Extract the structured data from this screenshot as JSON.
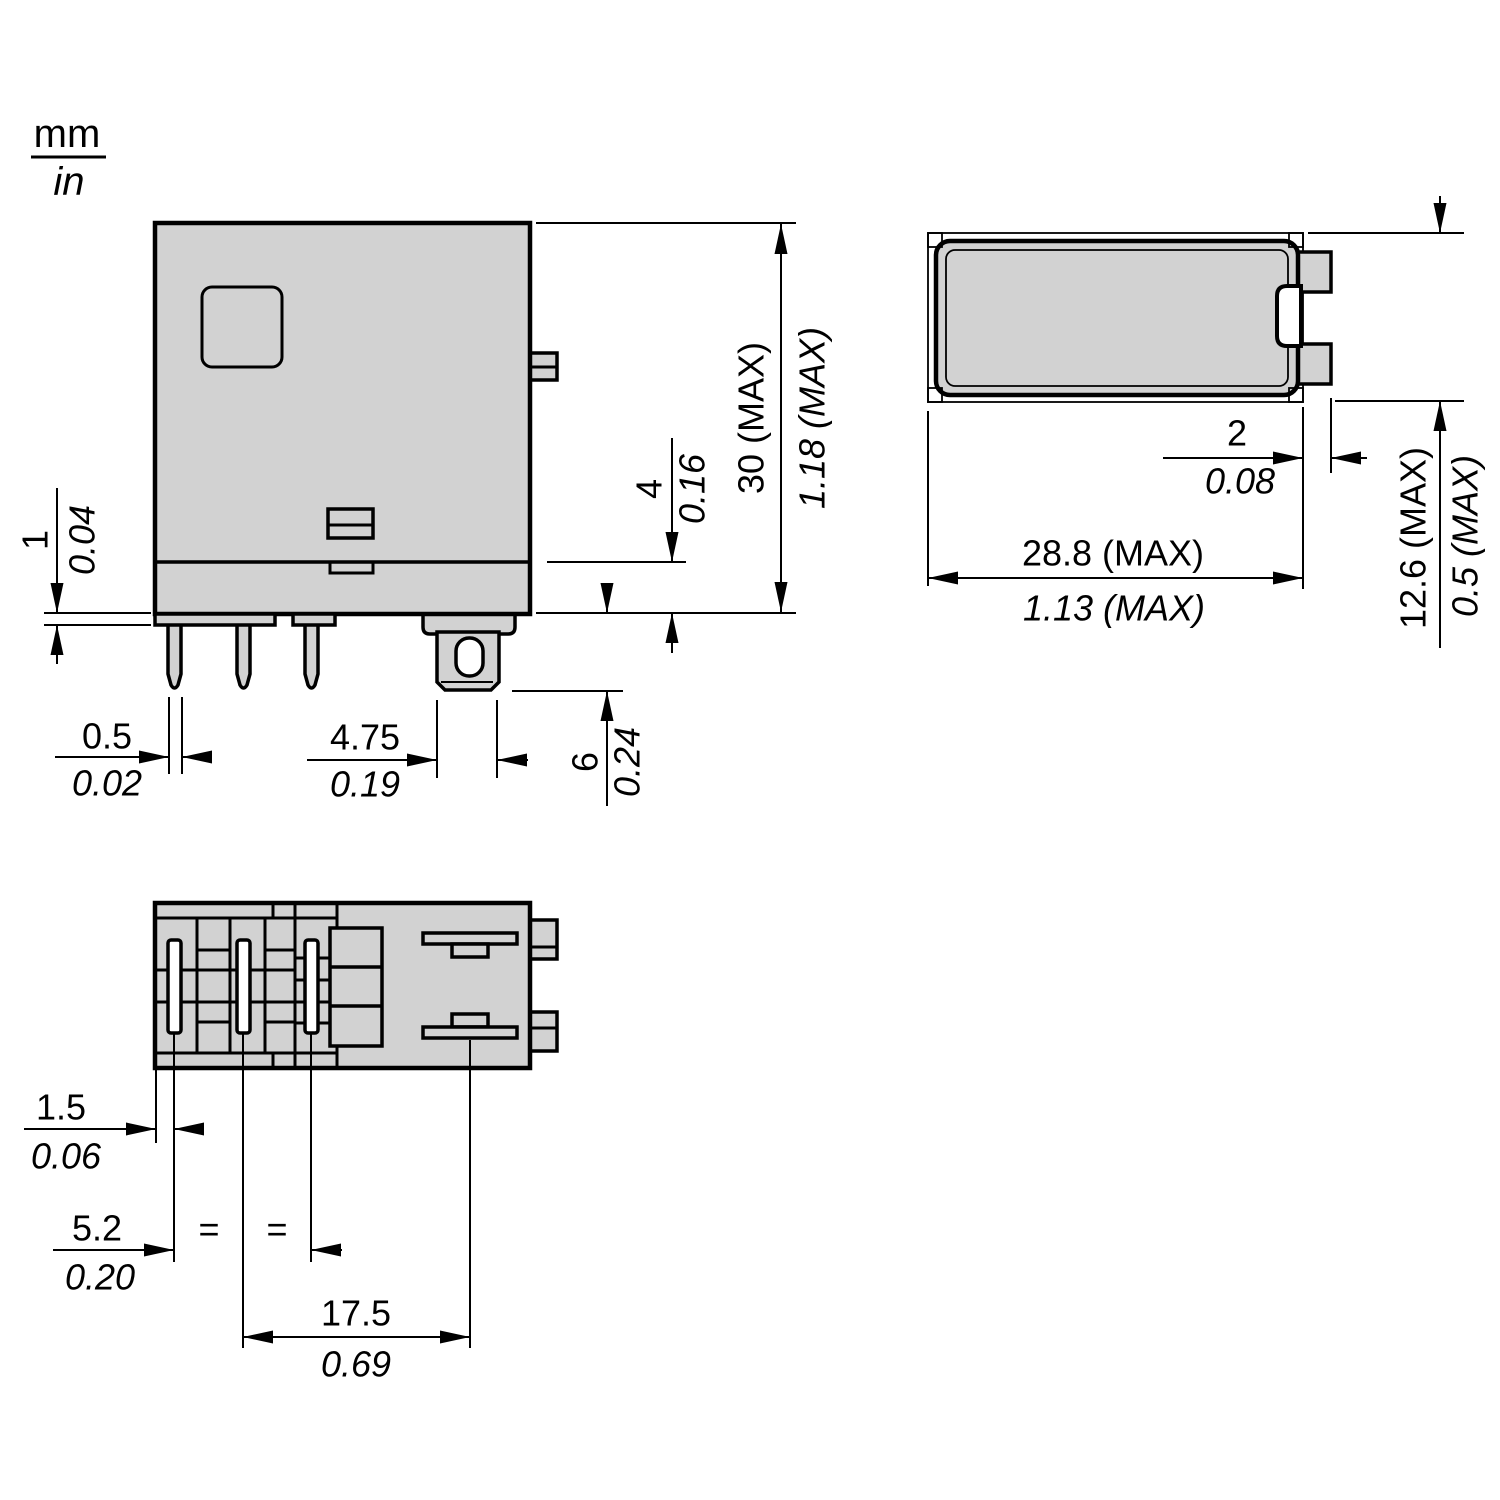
{
  "units_legend": {
    "numerator": "mm",
    "denominator": "in"
  },
  "dims": {
    "step_height": {
      "mm": "1",
      "in": "0.04"
    },
    "pin_thickness": {
      "mm": "0.5",
      "in": "0.02"
    },
    "terminal_width": {
      "mm": "4.75",
      "in": "0.19"
    },
    "base_height": {
      "mm": "4",
      "in": "0.16"
    },
    "pin_length": {
      "mm": "6",
      "in": "0.24"
    },
    "body_height": {
      "mm": "30 (MAX)",
      "in": "1.18 (MAX)"
    },
    "tab_protrusion": {
      "mm": "2",
      "in": "0.08"
    },
    "body_width": {
      "mm": "28.8 (MAX)",
      "in": "1.13 (MAX)"
    },
    "body_depth": {
      "mm": "12.6 (MAX)",
      "in": "0.5 (MAX)"
    },
    "edge_to_first_pin": {
      "mm": "1.5",
      "in": "0.06"
    },
    "pin_pitch": {
      "mm": "5.2",
      "in": "0.20"
    },
    "pin_to_terminal": {
      "mm": "17.5",
      "in": "0.69"
    }
  },
  "equal_marks": [
    "=",
    "="
  ],
  "colors": {
    "body_fill": "#d2d2d2",
    "line": "#000000",
    "background": "#ffffff"
  }
}
